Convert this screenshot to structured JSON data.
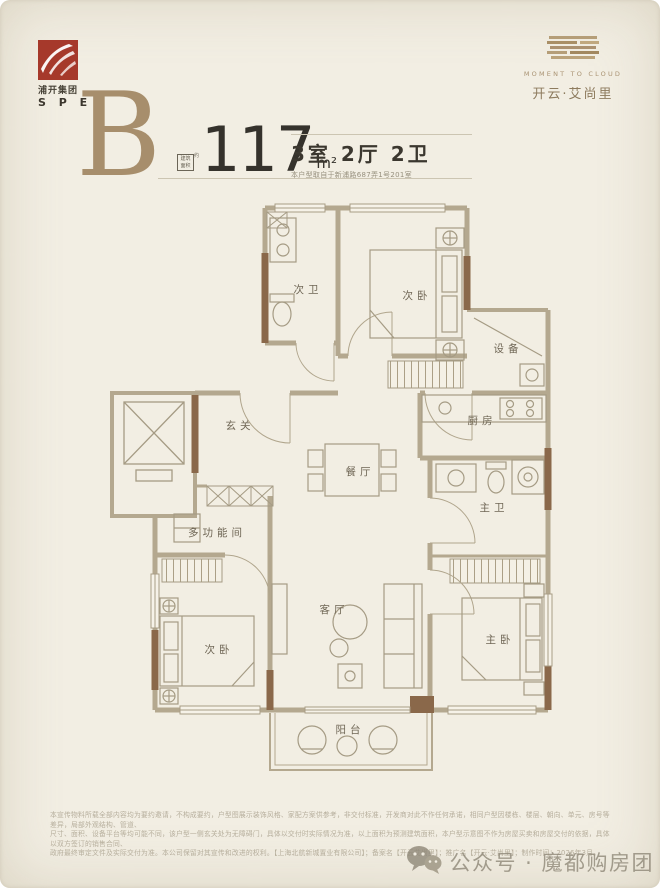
{
  "colors": {
    "background": "#f2eee3",
    "brand_red": "#a6392b",
    "gold": "#ab9170",
    "wall_gray": "#b4a88f",
    "wall_brown": "#8a684a",
    "text_dark": "#35322c",
    "label": "#6f6655"
  },
  "brand_left": {
    "line1": "浦开集团",
    "line2": "S P E"
  },
  "brand_right": {
    "tagline": "MOMENT TO CLOUD",
    "name": "开云·艾尚里"
  },
  "header": {
    "type_letter": "B",
    "area_box_line1": "建筑",
    "area_box_line2": "面积",
    "area_approx": "约",
    "area_value": "117",
    "area_unit": "m²",
    "layout": "3室 2厅 2卫",
    "source_note": "本户型取自于新浦路687弄1号201室"
  },
  "plan": {
    "rooms": {
      "bath2": "次卫",
      "bed2": "次卧",
      "equipment": "设备",
      "kitchen": "厨房",
      "foyer": "玄关",
      "dining": "餐厅",
      "bath1": "主卫",
      "multi": "多功能间",
      "bed3": "次卧",
      "living": "客厅",
      "master": "主卧",
      "balcony": "阳台"
    }
  },
  "footer": {
    "disclaimer_line1": "本宣传物料所载全部内容均为要约邀请，不构成要约，户型图展示装饰风格、家配方案供参考，非交付标准，开发商对此不作任何承诺，相同户型因楼栋、楼层、朝向、单元、房号等差异，局部外观结构、管道、",
    "disclaimer_line2": "尺寸、面积、设备平台等均可能不同，该户型一侧玄关处为无障碍门，具体以交付时实际情况为准，以上面积为预测建筑面积，本户型示意图不作为房屋买卖和房屋交付的依据，具体以双方签订的销售合同、",
    "disclaimer_line3": "政府最终审定文件及实际交付为准。本公司保留对其宣传和改进的权利。【上海北航新城置业有限公司】；备案名【开云艾尚里】；推广名【开云·艾尚里】；制作时间：2026年3月。",
    "wechat": "公众号 · 魔都购房团"
  }
}
